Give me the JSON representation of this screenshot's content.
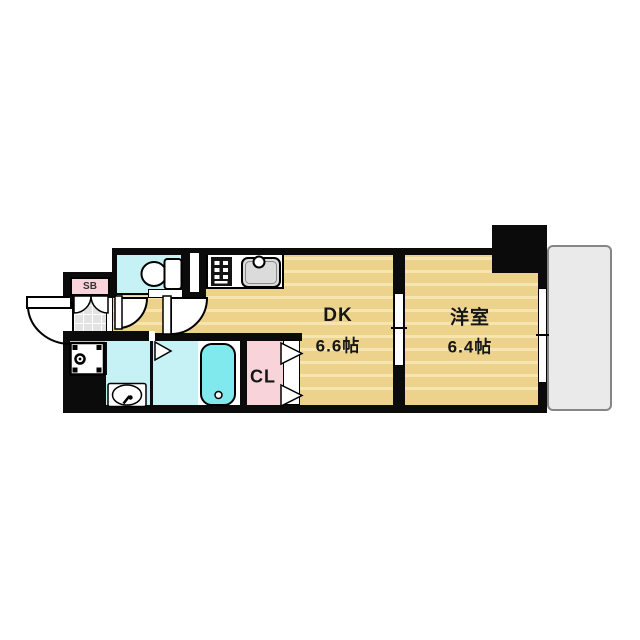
{
  "plan": {
    "type": "apartment-floor-plan",
    "rooms": {
      "dk": {
        "name": "DK",
        "area": "6.6帖"
      },
      "western": {
        "name": "洋室",
        "area": "6.4帖"
      },
      "closet": {
        "name": "CL"
      },
      "shoebox": {
        "name": "SB"
      }
    },
    "fixtures": [
      "entrance-door",
      "shoe-box-doors",
      "genkan-tile",
      "toilet",
      "pipe-shaft",
      "kitchen-stove",
      "kitchen-sink",
      "washing-machine-pan",
      "washbasin",
      "bathtub",
      "bath-folding-door",
      "closet-folding-doors",
      "sliding-door",
      "sliding-window",
      "balcony",
      "pillar"
    ],
    "colors": {
      "wall": "#0b0b0b",
      "wood_floor": "#edd28c",
      "wood_stripe": "#f6e5af",
      "wet_room": "#c6f2f5",
      "bathtub": "#7fe9ed",
      "pink": "#f8d3da",
      "genkan_tile": "#e3e3e3",
      "balcony": "#eaeaea"
    }
  }
}
